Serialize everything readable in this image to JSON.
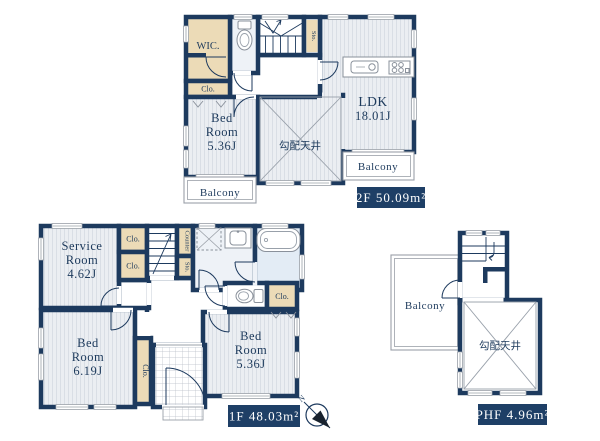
{
  "colors": {
    "wall": "#1d3a5e",
    "floor_stripe_bg": "#ebeef2",
    "floor_stripe_line": "#d9dee5",
    "closet_beige": "#ecdbb7",
    "bathroom_blue": "#e3ecf5",
    "washroom_blue": "#eef2f7",
    "area_label_box": "#1e3f66",
    "area_label_text": "#ffffff",
    "thin_line": "#9aa0a8",
    "text_navy": "#1d3a5c"
  },
  "floor2": {
    "area_label": "2F 50.09m²",
    "wic": "WIC.",
    "closet": "Clo.",
    "storage": "Sto.",
    "bedroom_name_1": "Bed",
    "bedroom_name_2": "Room",
    "bedroom_size": "5.36J",
    "ldk_name": "LDK",
    "ldk_size": "18.01J",
    "vaulted_ceiling": "勾配天井",
    "balcony_left": "Balcony",
    "balcony_right": "Balcony"
  },
  "floor1": {
    "area_label": "1F 48.03m²",
    "service_name_1": "Service",
    "service_name_2": "Room",
    "service_size": "4.62J",
    "closet_a": "Clo.",
    "closet_b": "Clo.",
    "counter": "Counter",
    "storage": "Sto.",
    "closet_right": "Clo.",
    "closet_vertical": "Clo.",
    "bedroom_left_1": "Bed",
    "bedroom_left_2": "Room",
    "bedroom_left_size": "6.19J",
    "bedroom_right_1": "Bed",
    "bedroom_right_2": "Room",
    "bedroom_right_size": "5.36J",
    "compass_north": "N"
  },
  "phf": {
    "area_label": "PHF 4.96m²",
    "balcony": "Balcony",
    "vaulted_ceiling": "勾配天井"
  }
}
